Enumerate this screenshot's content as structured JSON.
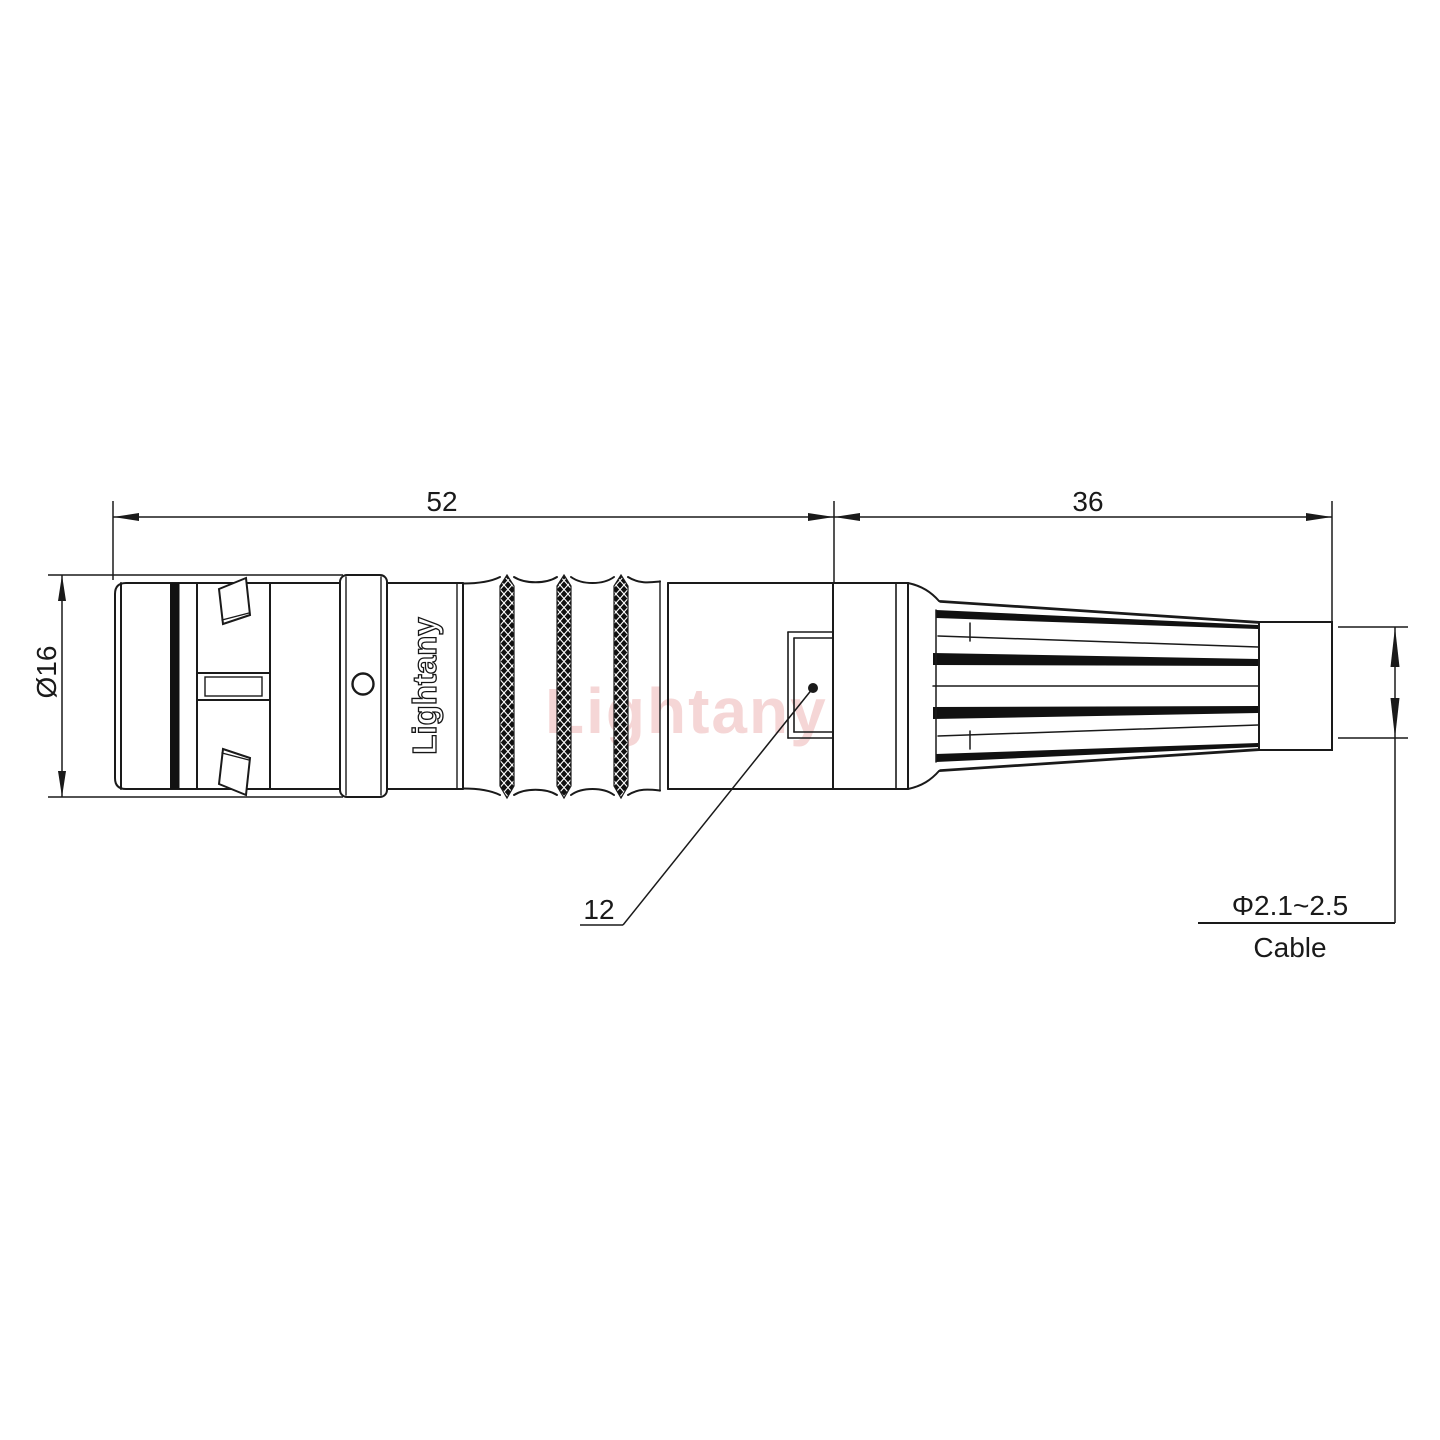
{
  "drawing": {
    "type": "technical-connector-drawing",
    "watermark_text": "Lightany",
    "shell_brand_text": "Lightany",
    "dimensions": {
      "body_length": "52",
      "boot_length": "36",
      "shell_diameter": "Ø16",
      "key_width": "12",
      "cable_range": "Φ2.1~2.5",
      "cable_label": "Cable"
    },
    "colors": {
      "line": "#1a1a1a",
      "background": "#ffffff",
      "watermark": "#d96666",
      "knurl_fill": "#101010"
    }
  }
}
